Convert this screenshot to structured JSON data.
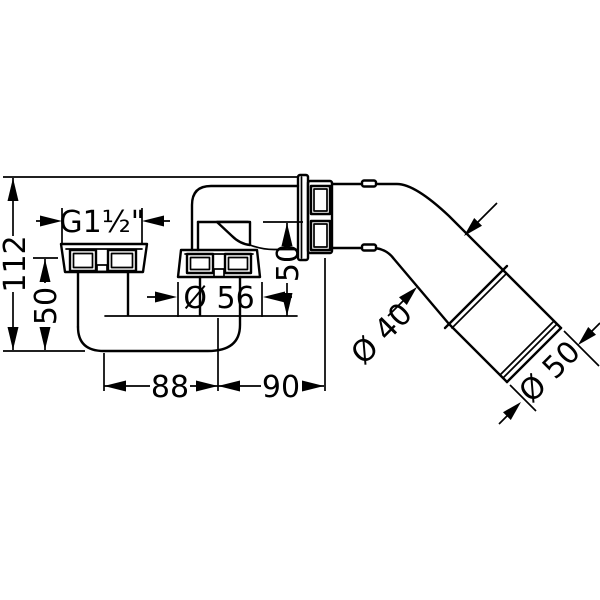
{
  "drawing": {
    "type": "technical-dimension-drawing",
    "subject": "bath waste and overflow trap fitting",
    "colors": {
      "line": "#000000",
      "background": "#ffffff"
    },
    "labels": {
      "total_height": "112",
      "left_height": "50",
      "thread_size": "G1½\"",
      "flange_diameter": "Ø 56",
      "overflow_height": "50",
      "span_left": "88",
      "span_right": "90",
      "pipe_diameter": "Ø 40",
      "outlet_diameter": "Ø 50"
    }
  }
}
